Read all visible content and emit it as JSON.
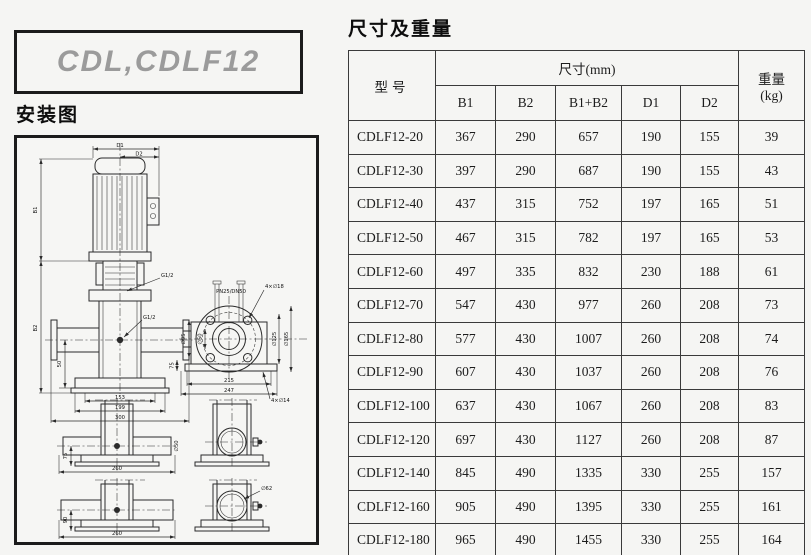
{
  "logo": {
    "text": "CDL,CDLF12"
  },
  "installation": {
    "title": "安装图"
  },
  "table_section": {
    "title": "尺寸及重量"
  },
  "table": {
    "col_model": "型号",
    "col_dims": "尺寸(mm)",
    "col_weight_line1": "重量",
    "col_weight_line2": "(kg)",
    "sub_cols": [
      "B1",
      "B2",
      "B1+B2",
      "D1",
      "D2"
    ],
    "rows": [
      {
        "model": "CDLF12-20",
        "values": [
          "367",
          "290",
          "657",
          "190",
          "155",
          "39"
        ]
      },
      {
        "model": "CDLF12-30",
        "values": [
          "397",
          "290",
          "687",
          "190",
          "155",
          "43"
        ]
      },
      {
        "model": "CDLF12-40",
        "values": [
          "437",
          "315",
          "752",
          "197",
          "165",
          "51"
        ]
      },
      {
        "model": "CDLF12-50",
        "values": [
          "467",
          "315",
          "782",
          "197",
          "165",
          "53"
        ]
      },
      {
        "model": "CDLF12-60",
        "values": [
          "497",
          "335",
          "832",
          "230",
          "188",
          "61"
        ]
      },
      {
        "model": "CDLF12-70",
        "values": [
          "547",
          "430",
          "977",
          "260",
          "208",
          "73"
        ]
      },
      {
        "model": "CDLF12-80",
        "values": [
          "577",
          "430",
          "1007",
          "260",
          "208",
          "74"
        ]
      },
      {
        "model": "CDLF12-90",
        "values": [
          "607",
          "430",
          "1037",
          "260",
          "208",
          "76"
        ]
      },
      {
        "model": "CDLF12-100",
        "values": [
          "637",
          "430",
          "1067",
          "260",
          "208",
          "83"
        ]
      },
      {
        "model": "CDLF12-120",
        "values": [
          "697",
          "430",
          "1127",
          "260",
          "208",
          "87"
        ]
      },
      {
        "model": "CDLF12-140",
        "values": [
          "845",
          "490",
          "1335",
          "330",
          "255",
          "157"
        ]
      },
      {
        "model": "CDLF12-160",
        "values": [
          "905",
          "490",
          "1395",
          "330",
          "255",
          "161"
        ]
      },
      {
        "model": "CDLF12-180",
        "values": [
          "965",
          "490",
          "1455",
          "330",
          "255",
          "164"
        ]
      }
    ]
  },
  "diagram": {
    "pump_view": {
      "dim_d1": "D1",
      "dim_d2": "D2",
      "dim_b1": "B1",
      "dim_b2": "B2",
      "port_top": "G1/2",
      "port_side": "G1/2",
      "dim_153": "153",
      "dim_199": "199",
      "dim_300": "300",
      "dim_50": "50"
    },
    "flange_view": {
      "spec": "PN25/DN50",
      "bolts_top": "4×∅18",
      "dia_125": "∅125",
      "dia_165": "∅165",
      "dia_95": "∅95",
      "dia_50": "∅50",
      "dim_215": "215",
      "dim_247": "247",
      "bolts_bottom": "4×∅14",
      "dim_75": "75"
    },
    "base_view_1": {
      "dim_h": "75",
      "dim_w": "260",
      "port": "∅50"
    },
    "base_view_2": {
      "dim_h": "90",
      "dim_w": "260",
      "port": "∅62"
    }
  },
  "colors": {
    "page_bg": "#f5f5f3",
    "line": "#2b2b2b",
    "logo_gray": "#9b9b9b"
  }
}
